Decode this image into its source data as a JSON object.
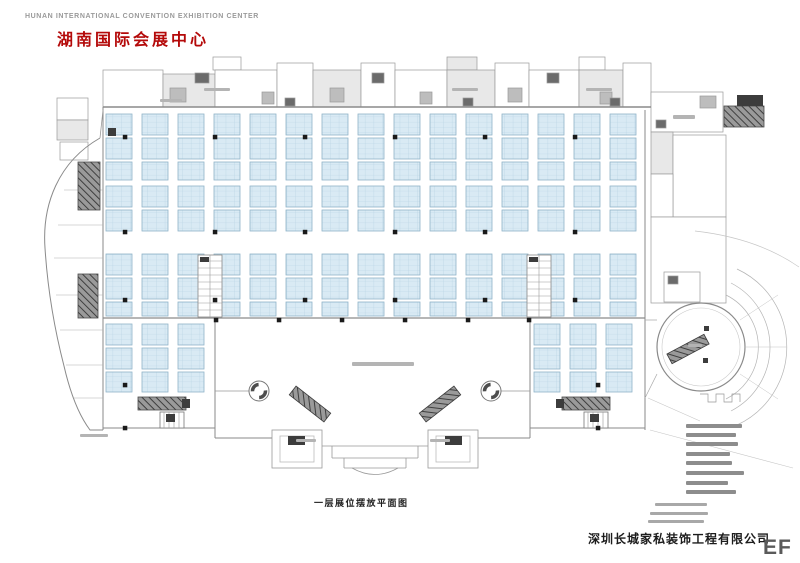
{
  "header": {
    "english_title": "HUNAN INTERNATIONAL CONVENTION EXHIBITION CENTER",
    "chinese_title": "湖南国际会展中心"
  },
  "footer": {
    "caption": "一层展位摆放平面图",
    "company_name": "深圳长城家私装饰工程有限公司",
    "watermark": "EF"
  },
  "colors": {
    "booth_fill": "#d9eaf4",
    "booth_grid": "#b5d1e2",
    "booth_border": "#8fb3c8",
    "wall": "#8a8a8a",
    "wall_dark": "#555555",
    "title_red": "#b40a0a",
    "text_gray": "#9a9a9a",
    "smudge_gray": "#b4b4b4",
    "legend_gray": "#8d8d8d",
    "dark_fill": "#3c3c3c"
  },
  "floor_plan": {
    "booth": {
      "pitch": 36,
      "strip_width": 26,
      "block_height": 21,
      "block_gap": 3,
      "bands": [
        {
          "x0": 106,
          "x1": 640,
          "y": 114,
          "h": 66
        },
        {
          "x0": 106,
          "x1": 640,
          "y": 186,
          "h": 45
        },
        {
          "x0": 106,
          "x1": 640,
          "y": 254,
          "h": 62
        },
        {
          "x0": 106,
          "x1": 213,
          "y": 324,
          "h": 68
        },
        {
          "x0": 534,
          "x1": 640,
          "y": 324,
          "h": 68
        }
      ]
    },
    "top_rooms": [
      [
        57,
        98,
        31,
        22,
        0
      ],
      [
        57,
        120,
        31,
        20,
        1
      ],
      [
        60,
        142,
        28,
        18,
        0
      ],
      [
        103,
        70,
        60,
        37,
        0
      ],
      [
        163,
        74,
        52,
        33,
        1
      ],
      [
        213,
        57,
        28,
        13,
        0
      ],
      [
        215,
        70,
        62,
        37,
        0
      ],
      [
        277,
        63,
        36,
        44,
        0
      ],
      [
        313,
        70,
        48,
        37,
        1
      ],
      [
        361,
        63,
        34,
        44,
        0
      ],
      [
        395,
        70,
        52,
        37,
        0
      ],
      [
        447,
        57,
        30,
        13,
        1
      ],
      [
        447,
        70,
        48,
        37,
        1
      ],
      [
        495,
        63,
        34,
        44,
        0
      ],
      [
        529,
        70,
        50,
        37,
        0
      ],
      [
        579,
        57,
        26,
        13,
        0
      ],
      [
        579,
        70,
        44,
        37,
        1
      ],
      [
        623,
        63,
        28,
        44,
        0
      ],
      [
        651,
        92,
        72,
        40,
        0
      ],
      [
        651,
        132,
        22,
        42,
        1
      ],
      [
        673,
        135,
        53,
        82,
        0
      ],
      [
        651,
        174,
        22,
        43,
        0
      ],
      [
        651,
        217,
        75,
        86,
        0
      ],
      [
        664,
        272,
        36,
        30,
        0
      ],
      [
        170,
        88,
        16,
        14,
        2
      ],
      [
        262,
        92,
        12,
        12,
        2
      ],
      [
        330,
        88,
        14,
        14,
        2
      ],
      [
        420,
        92,
        12,
        12,
        2
      ],
      [
        508,
        88,
        14,
        14,
        2
      ],
      [
        600,
        92,
        12,
        12,
        2
      ],
      [
        700,
        96,
        16,
        12,
        2
      ],
      [
        195,
        73,
        14,
        10,
        3
      ],
      [
        285,
        98,
        10,
        8,
        3
      ],
      [
        372,
        73,
        12,
        10,
        3
      ],
      [
        463,
        98,
        10,
        8,
        3
      ],
      [
        547,
        73,
        12,
        10,
        3
      ],
      [
        610,
        98,
        10,
        8,
        3
      ],
      [
        656,
        120,
        10,
        8,
        3
      ],
      [
        668,
        276,
        10,
        8,
        3
      ]
    ],
    "pillars": {
      "xs": [
        125,
        215,
        305,
        395,
        485,
        575
      ],
      "ys": [
        137,
        232,
        300
      ],
      "lobby_xs": [
        216,
        279,
        342,
        405,
        468,
        529
      ],
      "lobby_y": 320,
      "extra": [
        [
          125,
          385
        ],
        [
          598,
          385
        ],
        [
          125,
          428
        ],
        [
          598,
          428
        ]
      ]
    },
    "stair_cores": [
      [
        198,
        255,
        24,
        62
      ],
      [
        527,
        255,
        24,
        62
      ]
    ],
    "hatched_rects": [
      [
        78,
        162,
        22,
        48
      ],
      [
        78,
        274,
        20,
        44
      ],
      [
        138,
        397,
        48,
        13
      ],
      [
        562,
        397,
        48,
        13
      ],
      [
        724,
        106,
        40,
        21
      ]
    ],
    "escalators": [
      {
        "cx": 310,
        "cy": 404,
        "angle": 38,
        "len": 44,
        "w": 11
      },
      {
        "cx": 440,
        "cy": 404,
        "angle": 142,
        "len": 44,
        "w": 11
      },
      {
        "cx": 688,
        "cy": 349,
        "angle": -28,
        "len": 42,
        "w": 11
      }
    ],
    "stairs_small": [
      [
        160,
        412,
        24,
        16
      ],
      [
        584,
        412,
        24,
        16
      ]
    ],
    "dark_rects": [
      [
        737,
        95,
        26,
        11
      ],
      [
        182,
        399,
        8,
        9
      ],
      [
        556,
        399,
        8,
        9
      ],
      [
        288,
        436,
        17,
        9
      ],
      [
        445,
        436,
        17,
        9
      ],
      [
        704,
        326,
        5,
        5
      ],
      [
        703,
        358,
        5,
        5
      ],
      [
        200,
        257,
        9,
        5
      ],
      [
        529,
        257,
        9,
        5
      ],
      [
        166,
        414,
        9,
        8
      ],
      [
        590,
        414,
        9,
        8
      ],
      [
        108,
        128,
        8,
        8
      ]
    ],
    "lobby_circles": [
      [
        259,
        391,
        10
      ],
      [
        491,
        391,
        10
      ]
    ],
    "label_smudges": [
      [
        352,
        362,
        62,
        4
      ],
      [
        673,
        115,
        22,
        4
      ],
      [
        160,
        99,
        22,
        3
      ],
      [
        688,
        344,
        14,
        3
      ],
      [
        80,
        434,
        28,
        3
      ],
      [
        296,
        439,
        20,
        3
      ],
      [
        430,
        439,
        20,
        3
      ],
      [
        204,
        88,
        26,
        3
      ],
      [
        452,
        88,
        26,
        3
      ],
      [
        586,
        88,
        26,
        3
      ]
    ],
    "legend_smudges": [
      [
        686,
        424,
        56,
        4
      ],
      [
        686,
        433,
        50,
        4
      ],
      [
        686,
        442,
        52,
        4
      ],
      [
        686,
        452,
        44,
        4
      ],
      [
        686,
        461,
        46,
        4
      ],
      [
        686,
        471,
        58,
        4
      ],
      [
        686,
        481,
        42,
        4
      ],
      [
        686,
        490,
        50,
        4
      ]
    ],
    "note_smudges": [
      [
        655,
        503,
        52,
        3
      ],
      [
        650,
        512,
        58,
        3
      ],
      [
        648,
        520,
        56,
        3
      ]
    ]
  }
}
